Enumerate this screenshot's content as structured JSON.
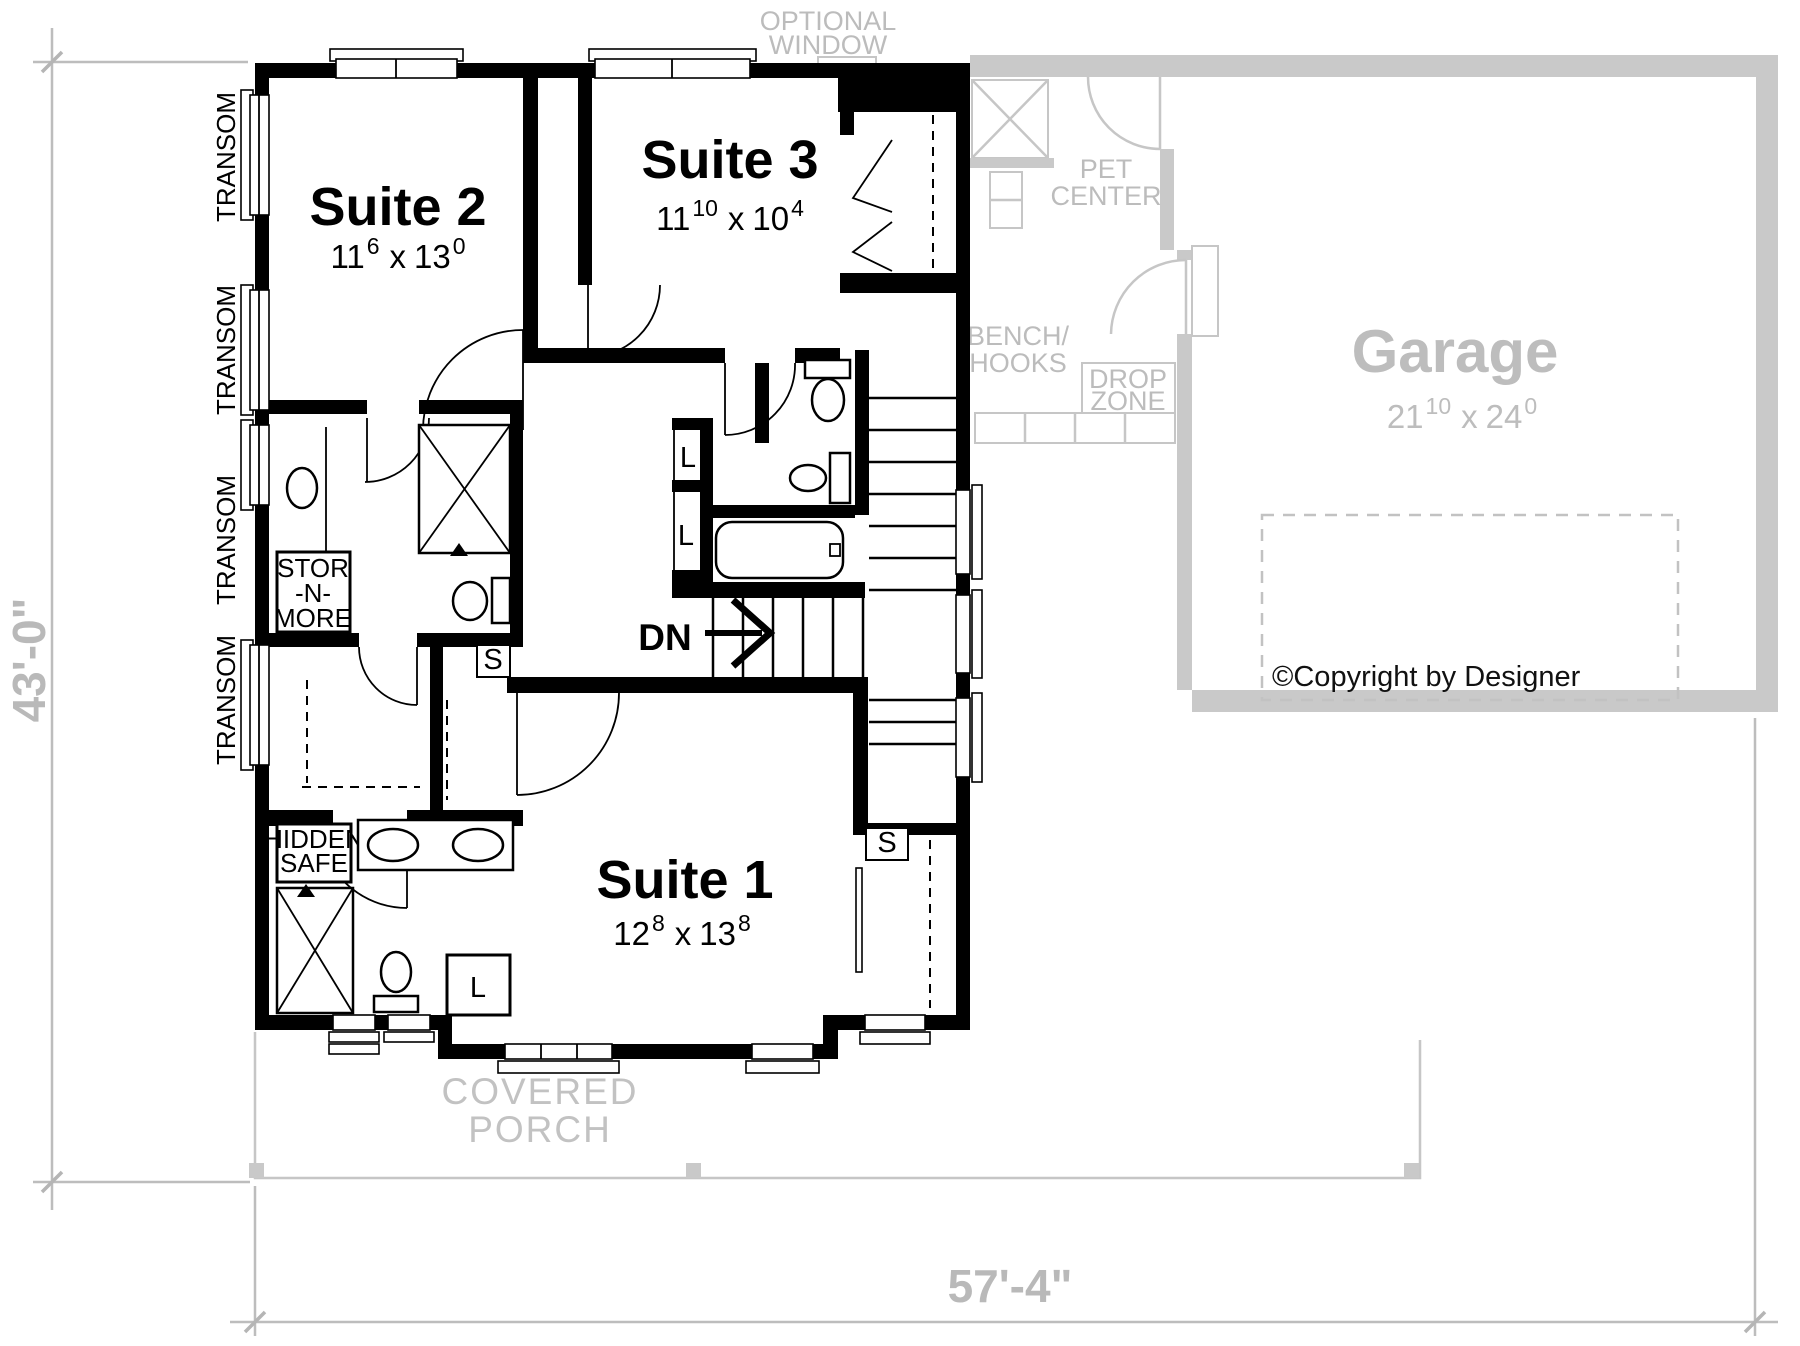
{
  "colors": {
    "wall_black": "#000000",
    "first_floor_gray_wall": "#c9c9c9",
    "gray_label_text": "#bcbcbc",
    "dimension_text": "#b9b9b9",
    "paper": "#ffffff"
  },
  "dim_sep": "x",
  "rooms": {
    "suite2": {
      "name": "Suite 2",
      "ft1": "11",
      "in1": "6",
      "ft2": "13",
      "in2": "0"
    },
    "suite3": {
      "name": "Suite 3",
      "ft1": "11",
      "in1": "10",
      "ft2": "10",
      "in2": "4"
    },
    "suite1": {
      "name": "Suite 1",
      "ft1": "12",
      "in1": "8",
      "ft2": "13",
      "in2": "8"
    },
    "garage": {
      "name": "Garage",
      "ft1": "21",
      "in1": "10",
      "ft2": "24",
      "in2": "0"
    }
  },
  "labels": {
    "optional_window_line1": "OPTIONAL",
    "optional_window_line2": "WINDOW",
    "pet_center_line1": "PET",
    "pet_center_line2": "CENTER",
    "bench_hooks_line1": "BENCH/",
    "bench_hooks_line2": "HOOKS",
    "drop_zone_line1": "DROP",
    "drop_zone_line2": "ZONE",
    "covered_porch_line1": "COVERED",
    "covered_porch_line2": "PORCH",
    "transom": "TRANSOM",
    "stor_n_more_line1": "STOR",
    "stor_n_more_line2": "-N-",
    "stor_n_more_line3": "MORE",
    "hidden_safe_line1": "HIDDEN",
    "hidden_safe_line2": "SAFE",
    "down": "DN",
    "linen": "L",
    "shelf": "S"
  },
  "dimensions": {
    "left": "43'-0\"",
    "bottom": "57'-4\""
  },
  "copyright": "©Copyright by Designer"
}
